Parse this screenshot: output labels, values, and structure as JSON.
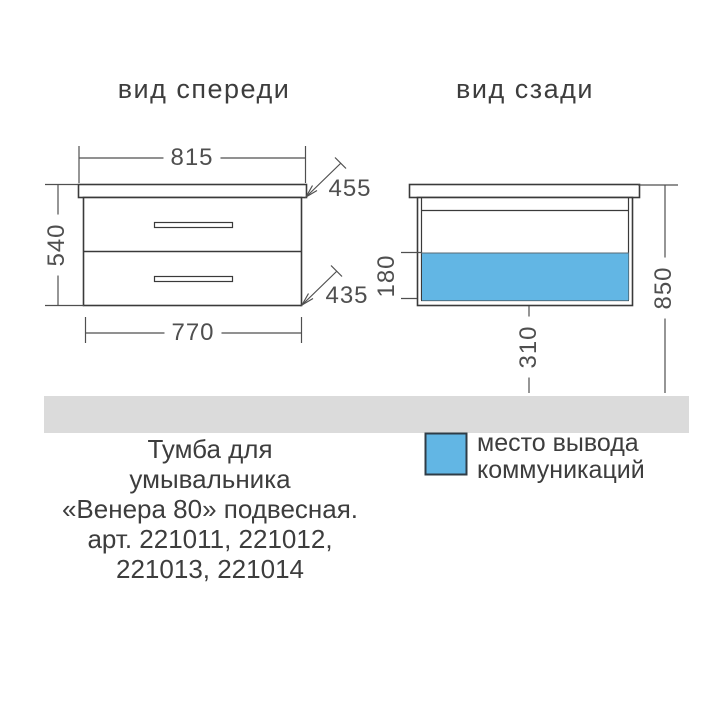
{
  "titles": {
    "front_view": "вид спереди",
    "rear_view": "вид сзади"
  },
  "front_view": {
    "dims": {
      "countertop_width": "815",
      "height": "540",
      "countertop_depth": "455",
      "body_depth": "435",
      "body_width": "770"
    }
  },
  "rear_view": {
    "dims": {
      "outlet_zone_height": "180",
      "outlet_zone_offset": "310",
      "total_height": "850"
    }
  },
  "legend": {
    "line1": "место вывода",
    "line2": "коммуникаций",
    "swatch_color": "#62b6e4"
  },
  "caption": {
    "lines": [
      "Тумба для",
      "умывальника",
      "«Венера 80» подвесная.",
      "арт. 221011, 221012,",
      "221013, 221014"
    ]
  },
  "colors": {
    "outline": "#3a3a3a",
    "dimension": "#4f4f4f",
    "highlight": "#62b6e4",
    "floor": "#dbdbdb"
  }
}
